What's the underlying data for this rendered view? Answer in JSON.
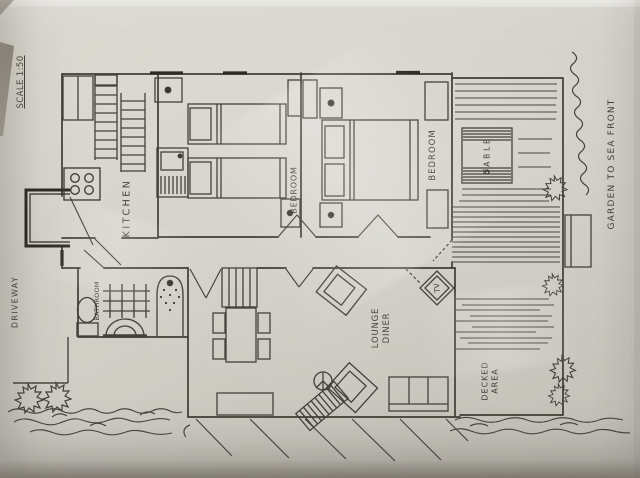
{
  "photo": {
    "description": "hand-drawn floor plan photograph",
    "colors": {
      "ink": "#413c34",
      "paper": "#d0cdc5",
      "edge_shadow": "#8b8478"
    }
  },
  "plan": {
    "scale_label": "SCALE 1:50",
    "labels": {
      "driveway": "DRIVEWAY",
      "kitchen": "KITCHEN",
      "bedroom_middle": "BEDROOM",
      "bedroom_right": "BEDROOM",
      "bathroom": "BATHROOM",
      "lounge_line1": "LOUNGE",
      "lounge_line2": "DINER",
      "table": "TABLE",
      "tv": "TV",
      "decked_line1": "DECKED",
      "decked_line2": "AREA",
      "garden": "GARDEN TO SEA FRONT"
    }
  }
}
